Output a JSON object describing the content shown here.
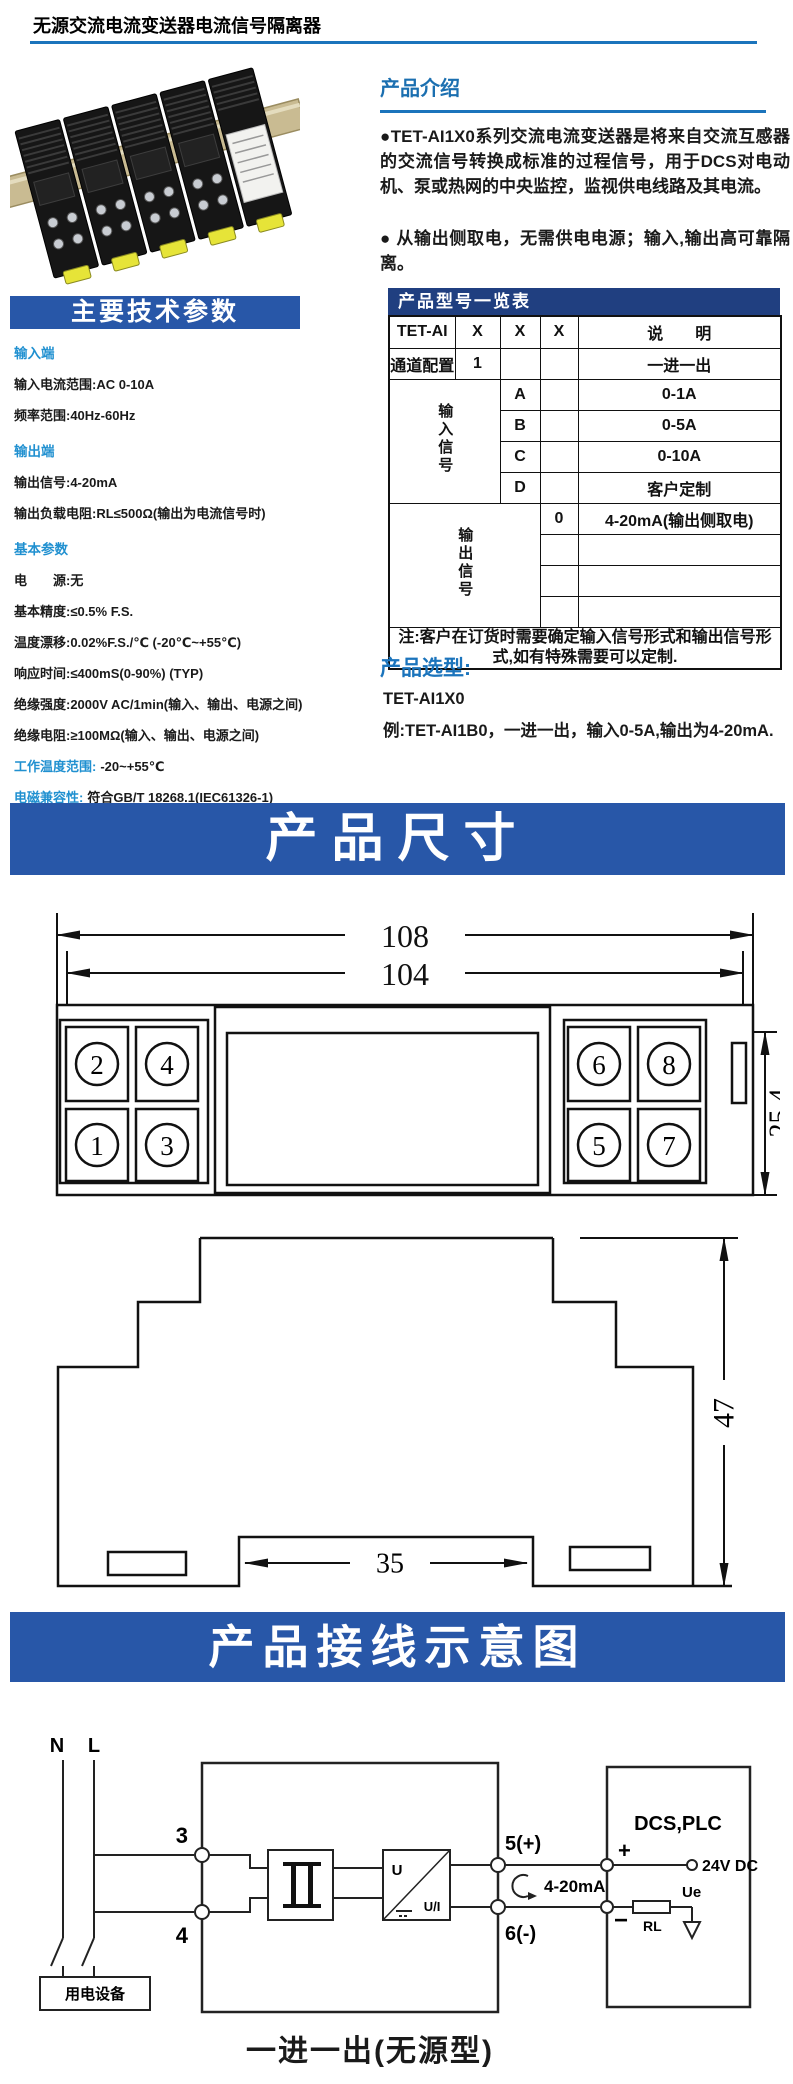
{
  "title": "无源交流电流变送器电流信号隔离器",
  "colors": {
    "accent_blue": "#1B74BC",
    "banner_blue": "#2857A8",
    "table_header_blue": "#203F80",
    "param_heading_blue": "#2090D0",
    "clip_yellow": "#E6E438"
  },
  "intro": {
    "heading": "产品介绍",
    "para1": "●TET-AI1X0系列交流电流变送器是将来自交流互感器的交流信号转换成标准的过程信号，用于DCS对电动机、泵或热网的中央监控，监视供电线路及其电流。",
    "para2": "● 从输出侧取电，无需供电电源；输入,输出高可靠隔离。"
  },
  "tech": {
    "banner": "主要技术参数",
    "groups": [
      {
        "heading": "输入端",
        "items": [
          "输入电流范围:AC 0-10A",
          "频率范围:40Hz-60Hz"
        ]
      },
      {
        "heading": "输出端",
        "items": [
          "输出信号:4-20mA",
          "输出负载电阻:RL≤500Ω(输出为电流信号时)"
        ]
      },
      {
        "heading": "基本参数",
        "items": [
          "电　　源:无",
          "基本精度:≤0.5% F.S.",
          "温度漂移:0.02%F.S./℃ (-20℃~+55℃)",
          "响应时间:≤400mS(0-90%) (TYP)",
          "绝缘强度:2000V AC/1min(输入、输出、电源之间)",
          "绝缘电阻:≥100MΩ(输入、输出、电源之间)"
        ]
      }
    ],
    "inline": [
      {
        "label": "工作温度范围:",
        "value": "-20~+55℃"
      },
      {
        "label": "电磁兼容性:",
        "value": "符合GB/T 18268.1(IEC61326-1)"
      }
    ]
  },
  "model_table": {
    "title": "产品型号一览表",
    "head": {
      "c1": "TET-AI",
      "c2": "X",
      "c3": "X",
      "c4": "X",
      "c5": "说　　明"
    },
    "channel": {
      "label": "通道配置",
      "code": "1",
      "desc": "一进一出"
    },
    "input": {
      "label": "输入信号",
      "rows": [
        {
          "code": "A",
          "desc": "0-1A"
        },
        {
          "code": "B",
          "desc": "0-5A"
        },
        {
          "code": "C",
          "desc": "0-10A"
        },
        {
          "code": "D",
          "desc": "客户定制"
        }
      ]
    },
    "output": {
      "label": "输出信号",
      "rows": [
        {
          "code": "0",
          "desc": "4-20mA(输出侧取电)"
        },
        {
          "code": "",
          "desc": ""
        },
        {
          "code": "",
          "desc": ""
        },
        {
          "code": "",
          "desc": ""
        }
      ]
    },
    "note": "注:客户在订货时需要确定输入信号形式和输出信号形式,如有特殊需要可以定制."
  },
  "selection": {
    "heading": "产品选型:",
    "model": "TET-AI1X0",
    "example": "例:TET-AI1B0，一进一出，输入0-5A,输出为4-20mA."
  },
  "dims": {
    "banner": "产品尺寸",
    "top_view": {
      "width_outer": "108",
      "width_inner": "104",
      "depth": "25.4",
      "terminals_left": [
        "2",
        "4",
        "1",
        "3"
      ],
      "terminals_right": [
        "6",
        "8",
        "5",
        "7"
      ]
    },
    "side_view": {
      "height": "47",
      "rail_width": "35"
    }
  },
  "wiring": {
    "banner": "产品接线示意图",
    "line_n": "N",
    "line_l": "L",
    "t3": "3",
    "t4": "4",
    "t5": "5(+)",
    "t6": "6(-)",
    "signal": "4-20mA",
    "u": "U",
    "ui": "U/I",
    "dcs": "DCS,PLC",
    "plus": "+",
    "minus": "−",
    "supply": "24V DC",
    "ue": "Ue",
    "rl": "RL",
    "load": "用电设备",
    "caption": "一进一出(无源型)"
  }
}
